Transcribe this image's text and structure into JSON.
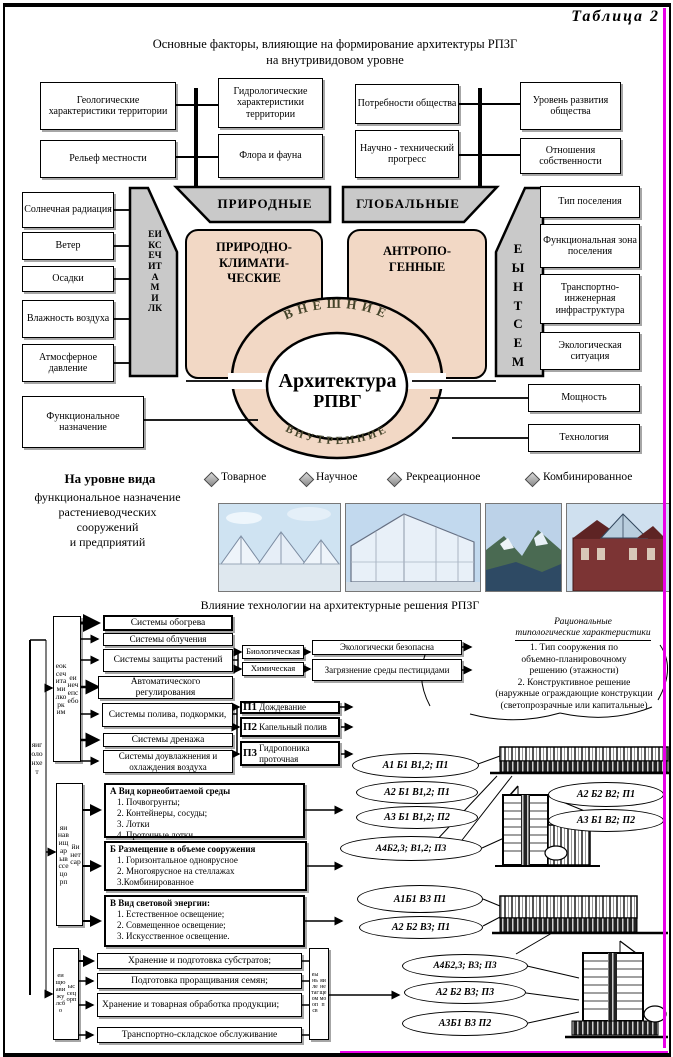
{
  "page": {
    "table_label": "Таблица 2"
  },
  "header": {
    "line1": "Основные факторы, влияющие  на  формирование  архитектуры РПЗГ",
    "line2": "на внутривидовом уровне"
  },
  "top_factors": {
    "row1": [
      "Геологические характеристики территории",
      "Гидрологические характеристики территории",
      "Потребности общества",
      "Уровень развития общества"
    ],
    "row2": [
      "Рельеф местности",
      "Флора и фауна",
      "Научно - технический прогресс",
      "Отношения собственности"
    ]
  },
  "core": {
    "left_boxes": [
      "Солнечная радиация",
      "Ветер",
      "Осадки",
      "Влажность воздуха",
      "Атмосферное давление",
      "Функциональное назначение"
    ],
    "right_boxes": [
      "Тип поселения",
      "Функциональная зона поселения",
      "Транспортно-инженерная инфраструктура",
      "Экологическая ситуация",
      "Мощность",
      "Технология"
    ],
    "trapezoid_left": "ПРИРОДНЫЕ",
    "trapezoid_right": "ГЛОБАЛЬНЫЕ",
    "band_left": "КЛИМАТИЧЕСКИЕ",
    "band_right": "МЕСТНЫЕ",
    "pink_left_lines": [
      "ПРИРОДНО-",
      "КЛИМАТИ-",
      "ЧЕСКИЕ"
    ],
    "pink_right_lines": [
      "АНТРОПО-",
      "ГЕННЫЕ"
    ],
    "ring_top": "ВНЕШНИЕ",
    "ring_bottom": "ВНУТРЕННИЕ",
    "center_line1": "Архитектура",
    "center_line2": "РПВГ"
  },
  "species": {
    "heading_bold": "На уровне вида",
    "lines": [
      "функциональное назначение",
      "растениеводческих",
      "сооружений",
      "и предприятий"
    ],
    "legend": [
      "Товарное",
      "Научное",
      "Рекреационное",
      "Комбинированное"
    ]
  },
  "tech": {
    "title": "Влияние технологии на архитектурные решения РПЗГ",
    "axis_label": "технология",
    "groups": [
      {
        "word1": "микроклиматическое",
        "word2": "обеспечение"
      },
      {
        "word1": "процесс выращивания",
        "word2": "растений"
      },
      {
        "word1": "обслуживающие",
        "word2": "процессы"
      }
    ],
    "systems": [
      "Системы обогрева",
      "Системы облучения",
      "Системы защиты растений",
      "Автоматического регулирования",
      "Системы полива, подкормки,",
      "Системы дренажа",
      "Системы доувлажнения и охлаждения воздуха"
    ],
    "protection_types": [
      "Биологическая",
      "Химическая"
    ],
    "protection_outcomes": [
      "Экологически безопасна",
      "Загрязнение среды пестицидами"
    ],
    "irrigation": [
      {
        "code": "П1",
        "label": "Дождевание"
      },
      {
        "code": "П2",
        "label": "Капельный полив"
      },
      {
        "code": "П3",
        "label": "Гидропоника проточная"
      }
    ],
    "blocks": [
      {
        "title": "А Вид корнеобитаемой среды",
        "items": [
          "1. Почвогрунты;",
          "2. Контейнеры, сосуды;",
          "3. Лотки",
          "4. Проточные лотки"
        ]
      },
      {
        "title": "Б Размещение в объеме сооружения",
        "items": [
          "1. Горизонтальное одноярусное",
          "2. Многоярусное на стеллажах",
          "3.Комбинированное"
        ]
      },
      {
        "title": "В Вид световой энергии:",
        "items": [
          "1. Естественное освещение;",
          "2. Совмещенное освещение;",
          "3. Искусственное освещение."
        ]
      }
    ],
    "service_items": [
      "Хранение и подготовка субстратов;",
      "Подготовка проращивания семян;",
      "Хранение и товарная обработка продукции;",
      "Транспортно-складское обслуживание"
    ],
    "service_side_word1": "вспомогательные",
    "service_side_word2": "помещения",
    "rational": {
      "heading_line1": "Рациональные",
      "heading_line2": "типологические характеристики",
      "lines": [
        "1. Тип сооружения по",
        "объемно-планировочному",
        "решению (этажности)",
        "2. Конструктивное решение",
        "(наружные ограждающие конструкции",
        "(светопрозрачные или капитальные)"
      ]
    },
    "code_ellipses": [
      "А1 Б1 В1,2; П1",
      "А2 Б1 В1,2; П1",
      "А3 Б1 В1,2; П2",
      "А4Б2,3; В1,2; П3",
      "А2 Б2 В2; П1",
      "А3 Б1 В2; П2",
      "А1Б1 В3 П1",
      "А2 Б2 В3; П1",
      "А4Б2,3; В3; П3",
      "А2 Б2 В3; П3",
      "А3Б1 В3 П2"
    ]
  },
  "colors": {
    "pink": "#f2d8c5",
    "grey": "#c9c9c9",
    "magenta": "#e800e8",
    "ring_text": "#44442a"
  }
}
